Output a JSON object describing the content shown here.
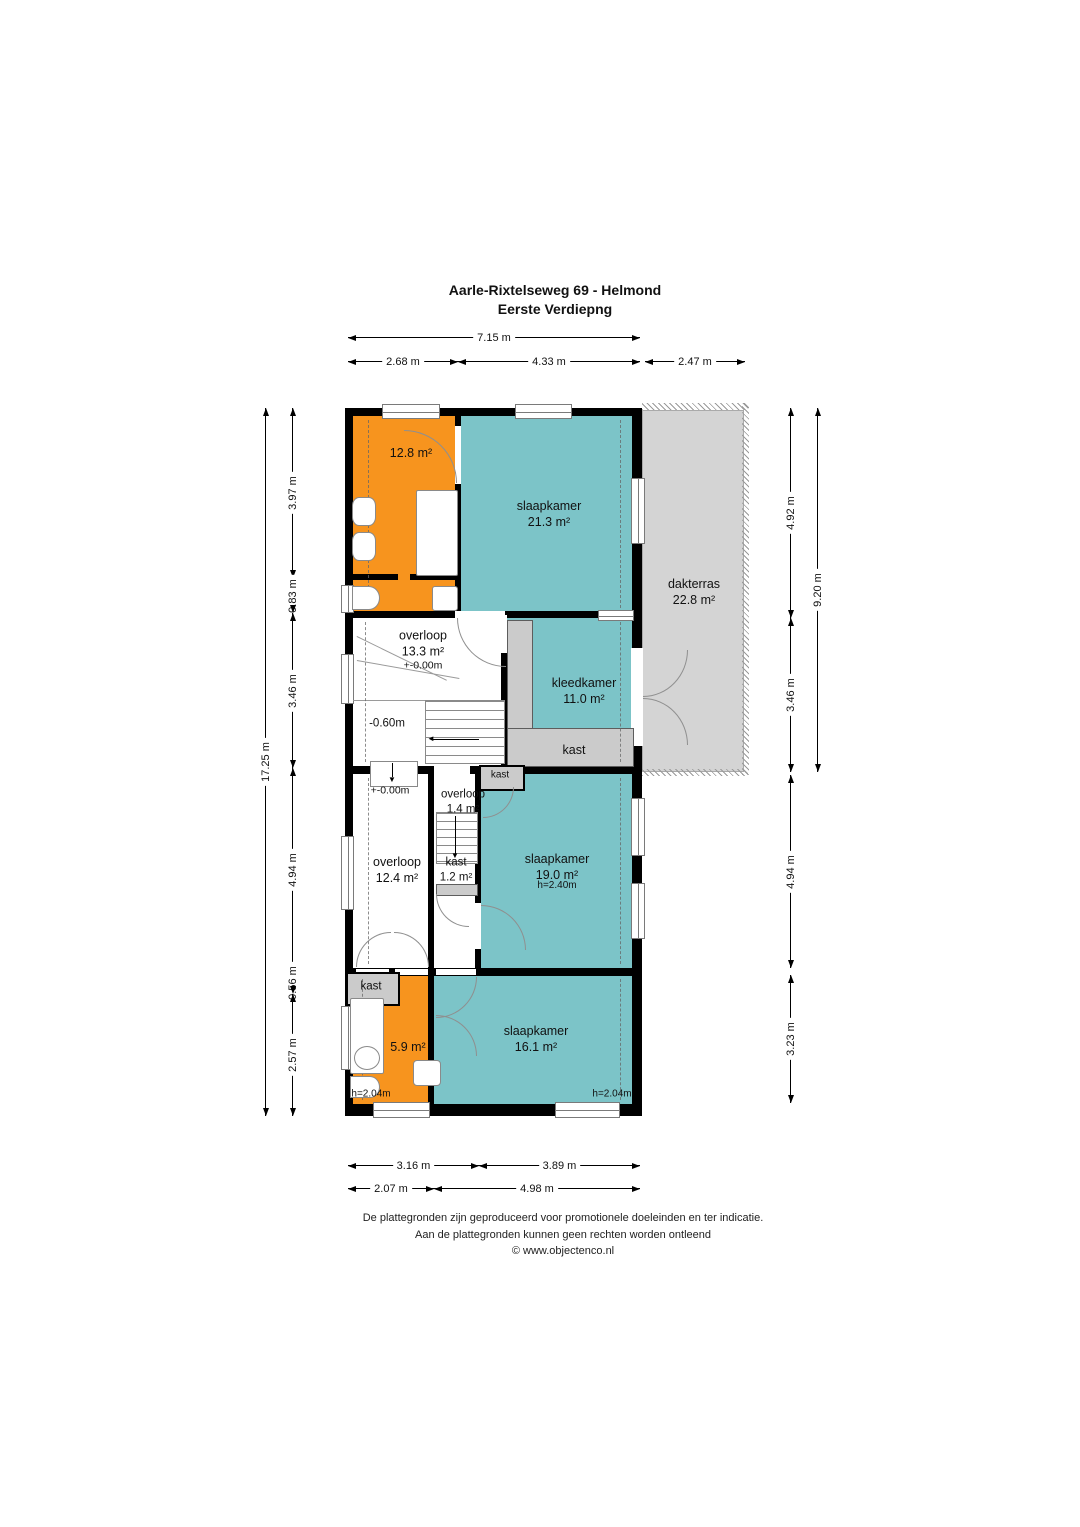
{
  "title": {
    "line1": "Aarle-Rixtelseweg 69 - Helmond",
    "line2": "Eerste Verdiepng"
  },
  "rooms": {
    "bath_top": {
      "area": "12.8 m²"
    },
    "slaapkamer_1": {
      "name": "slaapkamer",
      "area": "21.3 m²"
    },
    "dakterras": {
      "name": "dakterras",
      "area": "22.8 m²"
    },
    "overloop_1": {
      "name": "overloop",
      "area": "13.3 m²",
      "level": "+-0.00m",
      "sublevel": "-0.60m"
    },
    "kleedkamer": {
      "name": "kleedkamer",
      "area": "11.0 m²",
      "closet": "kast"
    },
    "kast_top": {
      "name": "kast"
    },
    "overloop_2": {
      "name": "overloop",
      "area": "1.4 m²"
    },
    "overloop_3": {
      "name": "overloop",
      "area": "12.4 m²",
      "level": "+-0.00m"
    },
    "kast_mid": {
      "name": "kast",
      "area": "1.2 m²"
    },
    "slaapkamer_2": {
      "name": "slaapkamer",
      "area": "19.0 m²",
      "height": "h=2.40m"
    },
    "kast_bottom": {
      "name": "kast"
    },
    "bath_bottom": {
      "area": "5.9 m²",
      "height": "h=2.04m"
    },
    "slaapkamer_3": {
      "name": "slaapkamer",
      "area": "16.1 m²",
      "height": "h=2.04m"
    }
  },
  "dimensions": {
    "top": {
      "overall": "7.15 m",
      "seg1": "2.68 m",
      "seg2": "4.33 m",
      "seg3": "2.47 m"
    },
    "left": {
      "overall": "17.25 m",
      "seg1": "3.97 m",
      "seg2": "0.83 m",
      "seg3": "3.46 m",
      "seg4": "4.94 m",
      "seg5": "0.56 m",
      "seg6": "2.57 m"
    },
    "right": {
      "overall": "9.20 m",
      "seg1": "4.92 m",
      "seg2": "3.46 m",
      "seg3": "4.94 m",
      "seg4": "3.23 m"
    },
    "bottom": {
      "seg1": "3.16 m",
      "seg2": "3.89 m",
      "seg3": "2.07 m",
      "seg4": "4.98 m"
    }
  },
  "footer": {
    "line1": "De plattegronden zijn geproduceerd voor promotionele doeleinden en ter indicatie.",
    "line2": "Aan de plattegronden kunnen geen rechten worden ontleend",
    "line3": "© www.objectenco.nl"
  },
  "icons": {
    "arrow_down": "▼",
    "arrow_left": "◄"
  },
  "colors": {
    "bathroom_orange": "#F7941E",
    "room_teal": "#7CC4C8",
    "terrace_gray": "#D4D4D4",
    "closet_gray": "#CBCBCB",
    "wall_black": "#000000"
  }
}
